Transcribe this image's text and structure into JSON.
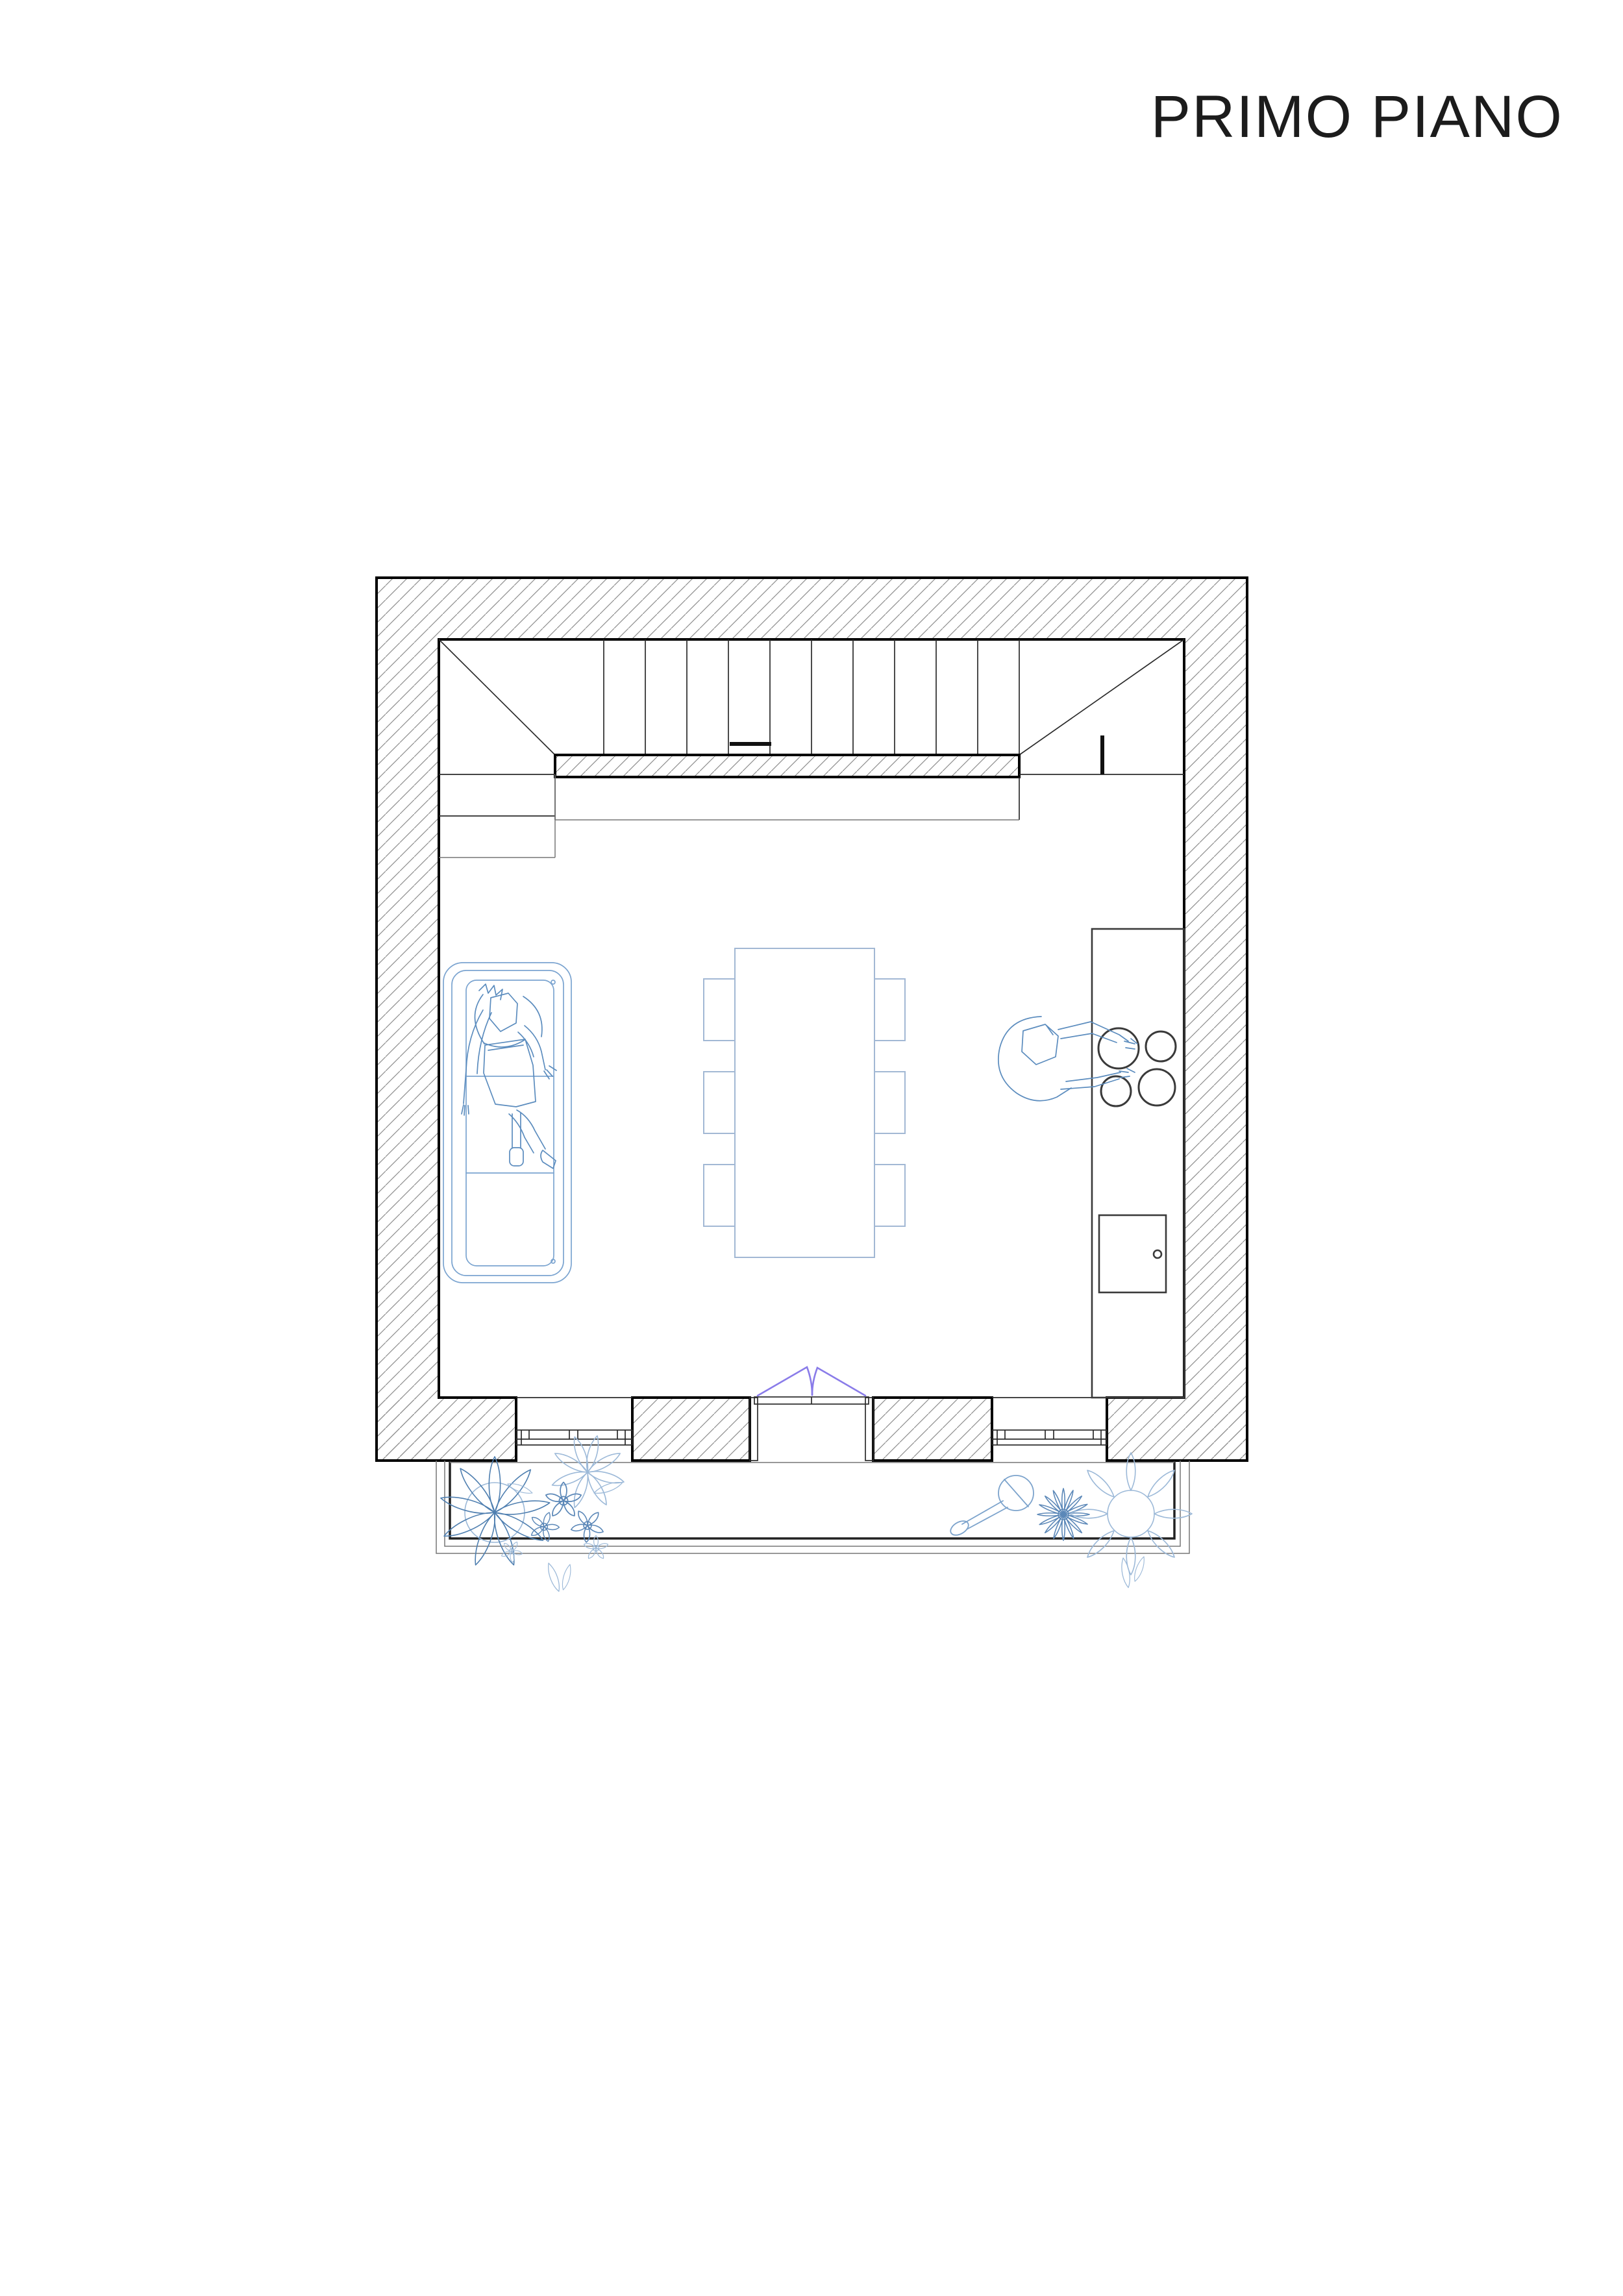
{
  "title": "PRIMO PIANO",
  "colors": {
    "background": "#ffffff",
    "ink": "#1c1c1c",
    "wall_line": "#000000",
    "hatch_line": "#8e8e8e",
    "detail_line": "#2b2b2b",
    "light_line": "#777777",
    "sofa_blue": "#5b8cbe",
    "sofa_outline_blue": "#7ba4d0",
    "table_blue": "#a2b8d4",
    "counter_line": "#3a3a3a",
    "plant_blue": "#4f7fb0",
    "plant_blue_light": "#9cb9d8",
    "flower_blue": "#5c88b8",
    "watering_can_blue": "#7ca3cc",
    "door_swing_purple": "#8a7ce9"
  }
}
